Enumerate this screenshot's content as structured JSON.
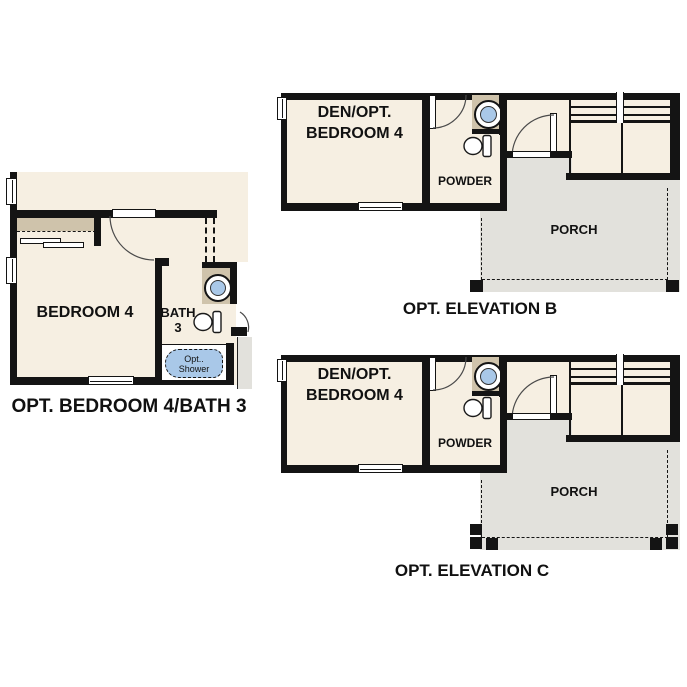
{
  "colors": {
    "wall": "#141414",
    "room_cream": "#f6efe2",
    "counter_tan": "#cfc3ab",
    "fixture_blue": "#a9c8e8",
    "porch_gray": "#e2e1dc",
    "text": "#111111"
  },
  "plans": {
    "bedroom4": {
      "caption": "OPT. BEDROOM 4/BATH 3",
      "bedroom_label": "BEDROOM 4",
      "bath_label_line1": "BATH",
      "bath_label_line2": "3",
      "shower_label_line1": "Opt..",
      "shower_label_line2": "Shower"
    },
    "elevation_b": {
      "caption": "OPT. ELEVATION B",
      "den_label_line1": "DEN/OPT.",
      "den_label_line2": "BEDROOM 4",
      "powder_label": "POWDER",
      "porch_label": "PORCH"
    },
    "elevation_c": {
      "caption": "OPT. ELEVATION C",
      "den_label_line1": "DEN/OPT.",
      "den_label_line2": "BEDROOM 4",
      "powder_label": "POWDER",
      "porch_label": "PORCH"
    }
  }
}
